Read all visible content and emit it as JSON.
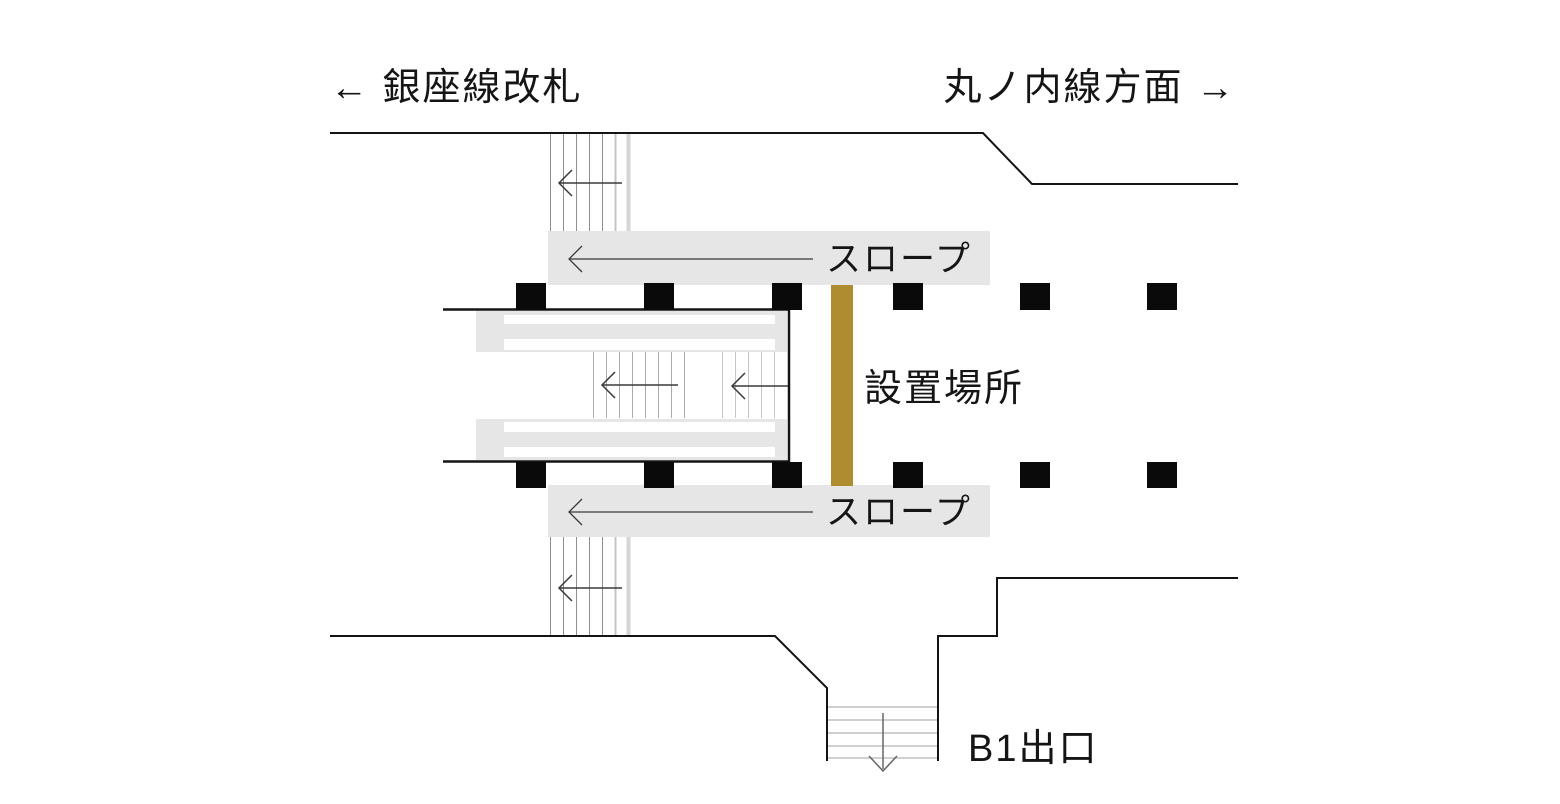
{
  "diagram_title": "station platform floor plan",
  "labels": {
    "ginza_gate": "← 銀座線改札",
    "marunouchi_direction": "丸ノ内線方面 →",
    "slope_top": "スロープ",
    "slope_bottom": "スロープ",
    "installation_location": "設置場所",
    "b1_exit": "B1出口"
  },
  "colors": {
    "accent_gold": "#AF8C2F",
    "band_gray": "#E6E6E6",
    "line_black": "#141414",
    "stair_gray": "#909090",
    "pillar_black": "#0a0a0a"
  }
}
